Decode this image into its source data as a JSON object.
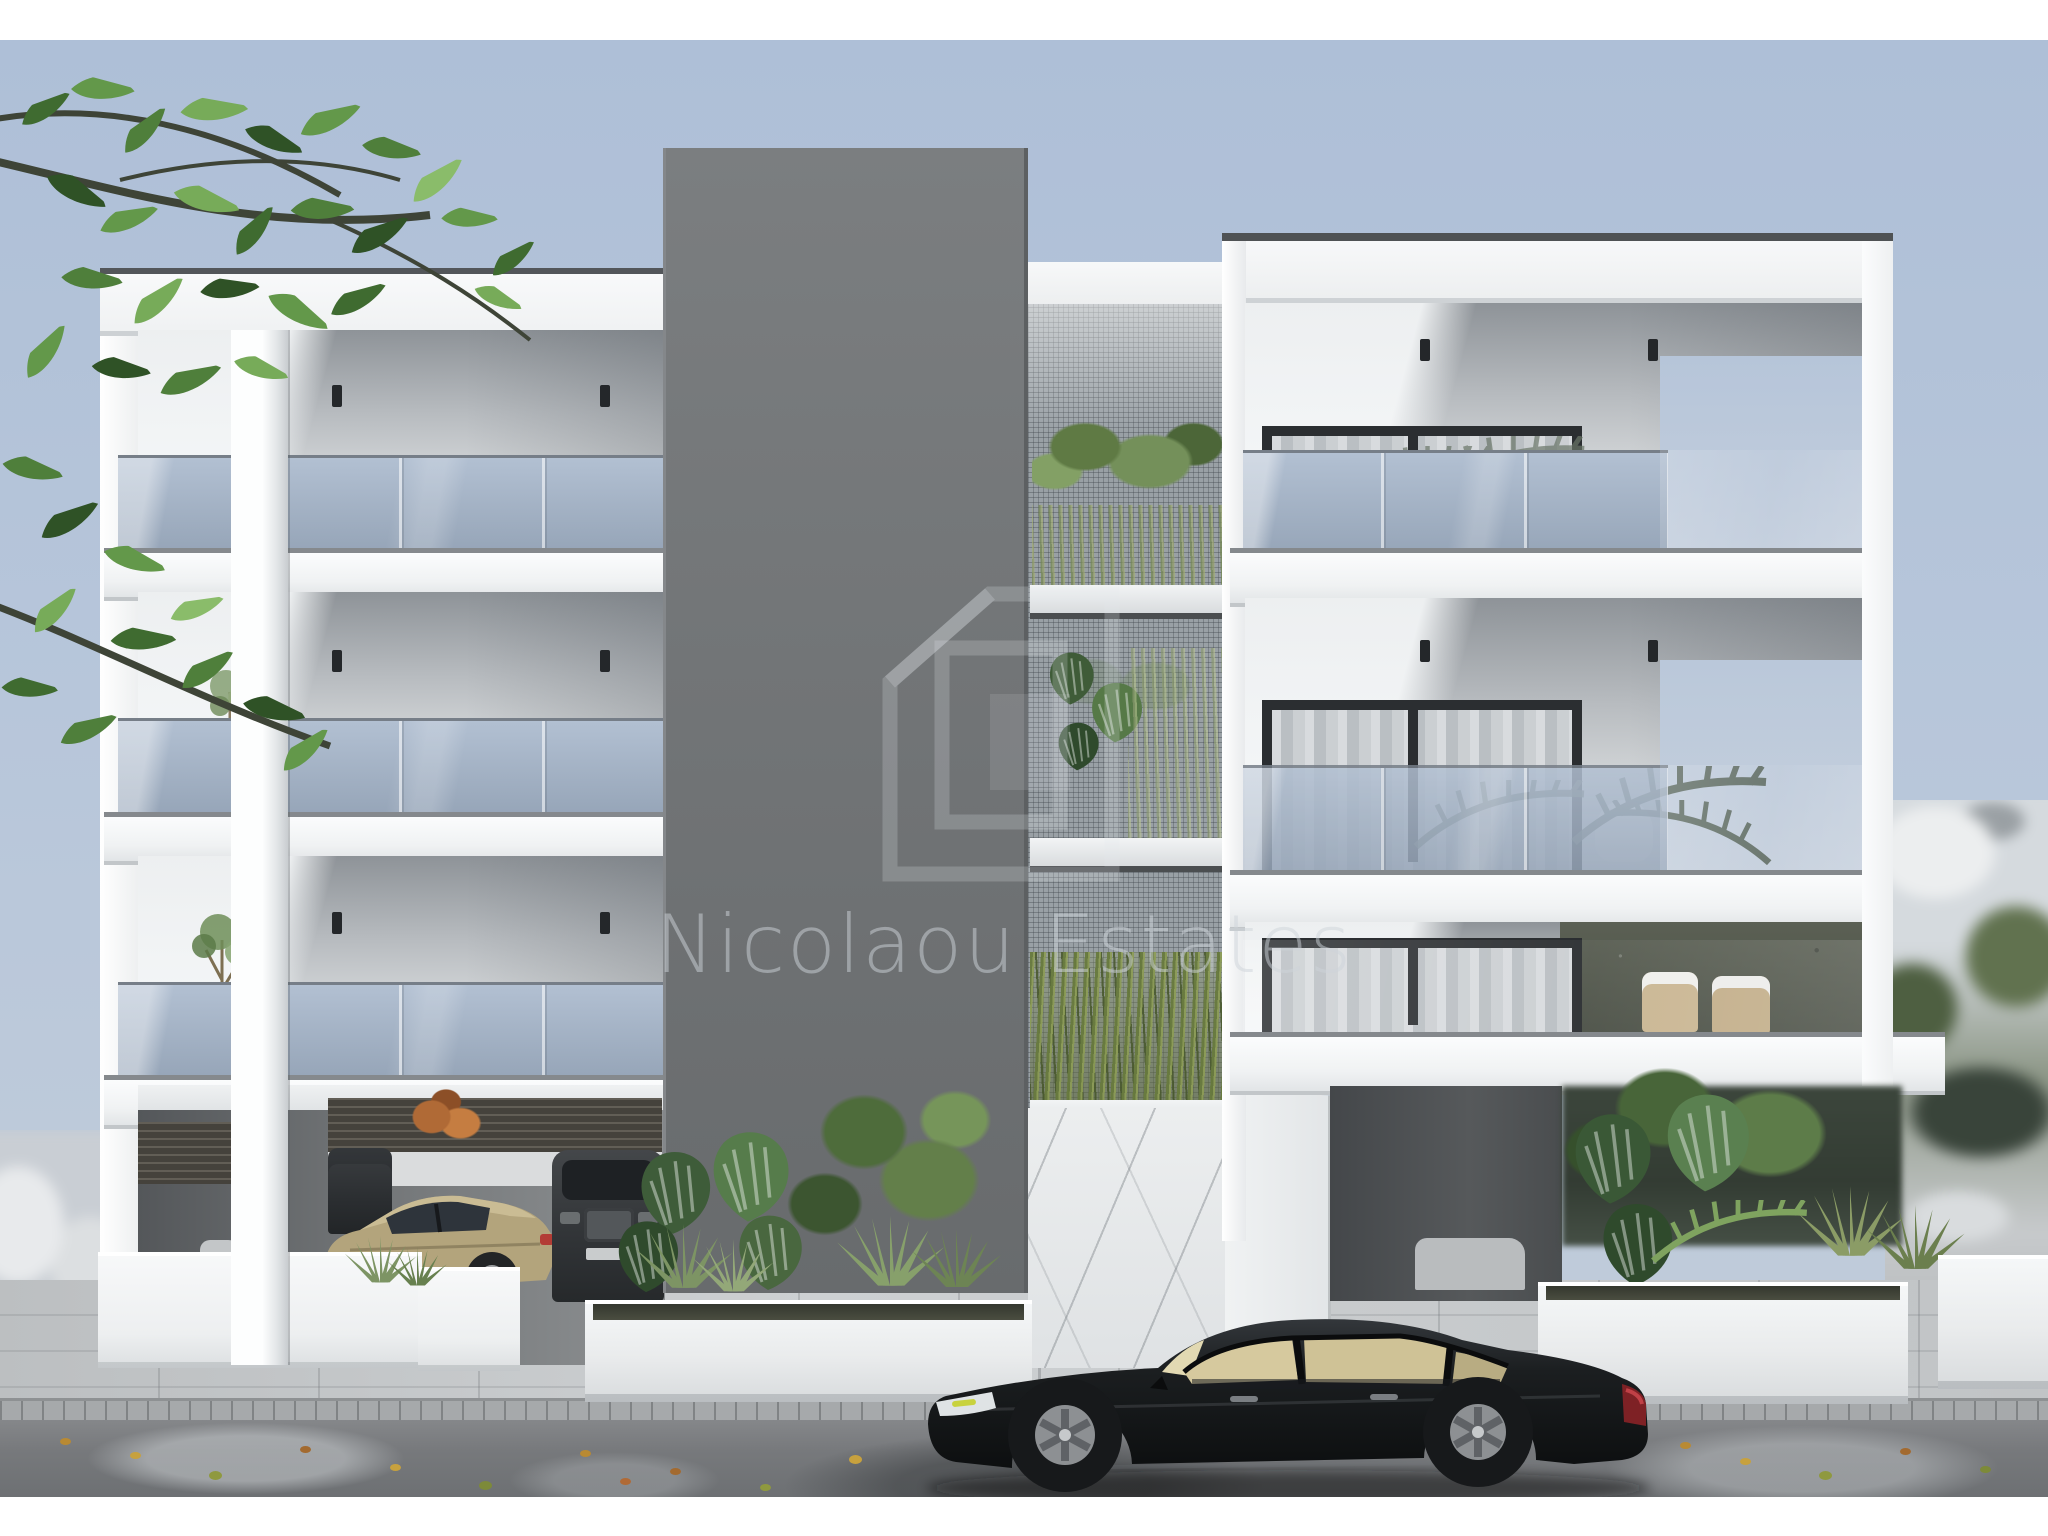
{
  "watermark": {
    "name": "Nicolaou Estates",
    "logo_icon": "nested-squares-logo",
    "text_color": "rgba(206,212,218,0.5)"
  },
  "scene": {
    "type": "architectural-3d-render",
    "subject": "Modern three-storey apartment building with glass balconies",
    "setting": "Street-level exterior view with covered parking, planters, tropical landscaping and parked cars",
    "palette": {
      "sky": "#b7c6da",
      "building_white": "#f2f4f5",
      "feature_wall_gray": "#717476",
      "balcony_glass": "#a4b3c6",
      "foliage_green": "#577a41",
      "pavement": "#c6c9cb",
      "wet_asphalt": "#77797c",
      "black_sedan": "#17191b",
      "gold_coupe": "#b3a47c"
    },
    "objects": [
      "left-apartment-block",
      "central-feature-tower",
      "green-wall-mesh",
      "marble-entrance-wall",
      "right-apartment-block",
      "covered-parking-with-cars",
      "street-planters",
      "foreground-black-sedan",
      "overhanging-tree-branches",
      "blurred-neighbourhood-background"
    ]
  }
}
